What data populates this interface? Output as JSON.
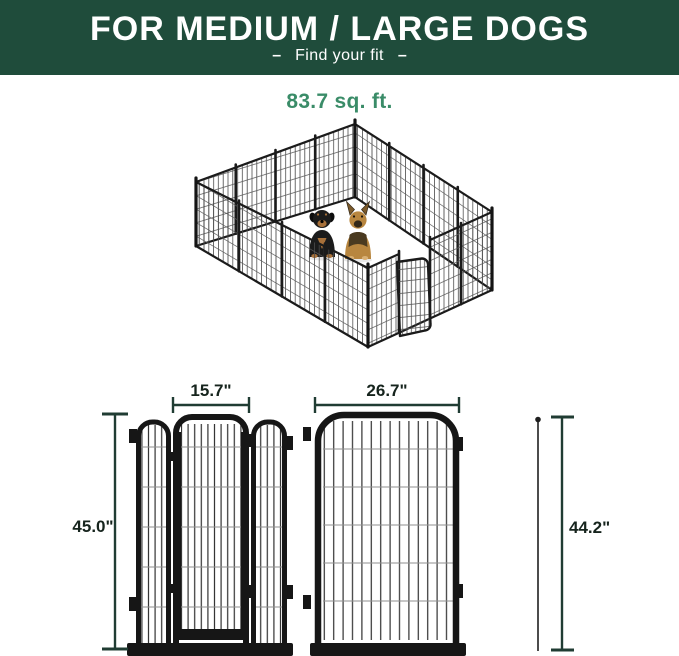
{
  "header": {
    "title": "FOR MEDIUM / LARGE DOGS",
    "dash": "–",
    "subtitle": "Find your fit",
    "bg_color": "#1f4c3b",
    "text_color": "#ffffff"
  },
  "hero": {
    "area_label": "83.7 sq. ft.",
    "accent_color": "#3a8c68",
    "dogs": [
      "rottweiler",
      "german-shepherd"
    ],
    "pen_color": "#1b1b1b"
  },
  "diagrams": {
    "dimension_color": "#203c33",
    "label_color": "#16241d",
    "door_panel": {
      "door_width": "15.7\"",
      "panel_height": "45.0\""
    },
    "regular_panel": {
      "panel_width": "26.7\"",
      "rod_height": "44.2\""
    }
  }
}
